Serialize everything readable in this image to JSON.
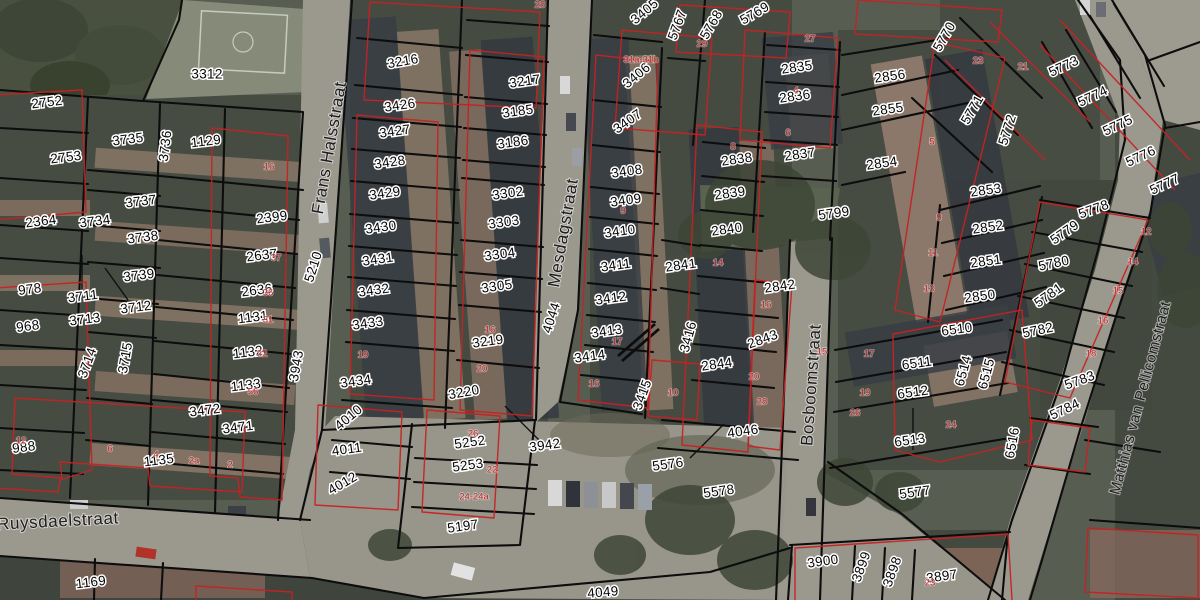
{
  "map": {
    "type": "cadastral-aerial-map",
    "colors": {
      "parcel_line": "#0d0d0d",
      "building_outline": "#c62222",
      "red_label": "#c22121",
      "halo": "#ffffff"
    },
    "streets": [
      {
        "label": "Frans Halsstraat",
        "x": 330,
        "y": 148,
        "r": -80,
        "s": 17
      },
      {
        "label": "Mesdagstraat",
        "x": 564,
        "y": 233,
        "r": -80,
        "s": 17
      },
      {
        "label": "Bosboomstraat",
        "x": 812,
        "y": 385,
        "r": -86,
        "s": 17
      },
      {
        "label": "Matthias van Pellicomstraat",
        "x": 1141,
        "y": 398,
        "r": -75,
        "s": 15
      },
      {
        "label": "Ruysdaelstraat",
        "x": 58,
        "y": 522,
        "r": -3,
        "s": 17
      }
    ],
    "parcels": [
      {
        "id": "3312",
        "x": 207,
        "y": 75,
        "r": 0
      },
      {
        "id": "2752",
        "x": 47,
        "y": 103,
        "r": -7
      },
      {
        "id": "2753",
        "x": 66,
        "y": 158,
        "r": -7
      },
      {
        "id": "3735",
        "x": 128,
        "y": 140,
        "r": -7
      },
      {
        "id": "3736",
        "x": 166,
        "y": 146,
        "r": -83
      },
      {
        "id": "1129",
        "x": 206,
        "y": 142,
        "r": -7
      },
      {
        "id": "2364",
        "x": 41,
        "y": 222,
        "r": -7
      },
      {
        "id": "3734",
        "x": 95,
        "y": 222,
        "r": -7
      },
      {
        "id": "3737",
        "x": 141,
        "y": 202,
        "r": -7
      },
      {
        "id": "3738",
        "x": 143,
        "y": 238,
        "r": -7
      },
      {
        "id": "3739",
        "x": 139,
        "y": 276,
        "r": -7
      },
      {
        "id": "978",
        "x": 30,
        "y": 290,
        "r": -7
      },
      {
        "id": "3711",
        "x": 83,
        "y": 297,
        "r": -7
      },
      {
        "id": "3712",
        "x": 136,
        "y": 308,
        "r": -7
      },
      {
        "id": "3713",
        "x": 85,
        "y": 320,
        "r": -7
      },
      {
        "id": "968",
        "x": 28,
        "y": 327,
        "r": -7
      },
      {
        "id": "2399",
        "x": 272,
        "y": 218,
        "r": -7
      },
      {
        "id": "2637",
        "x": 262,
        "y": 256,
        "r": -7
      },
      {
        "id": "2636",
        "x": 257,
        "y": 291,
        "r": -7
      },
      {
        "id": "1131",
        "x": 253,
        "y": 318,
        "r": -7
      },
      {
        "id": "1132",
        "x": 248,
        "y": 353,
        "r": -7
      },
      {
        "id": "1133",
        "x": 246,
        "y": 386,
        "r": -7
      },
      {
        "id": "3714",
        "x": 88,
        "y": 363,
        "r": -70
      },
      {
        "id": "3715",
        "x": 126,
        "y": 358,
        "r": -80
      },
      {
        "id": "3472",
        "x": 205,
        "y": 411,
        "r": -7
      },
      {
        "id": "3471",
        "x": 238,
        "y": 428,
        "r": -7
      },
      {
        "id": "988",
        "x": 24,
        "y": 448,
        "r": -7
      },
      {
        "id": "1135",
        "x": 159,
        "y": 461,
        "r": -7
      },
      {
        "id": "1169",
        "x": 91,
        "y": 583,
        "r": -7
      },
      {
        "id": "3943",
        "x": 297,
        "y": 366,
        "r": -80
      },
      {
        "id": "5210",
        "x": 314,
        "y": 267,
        "r": -72
      },
      {
        "id": "3216",
        "x": 403,
        "y": 62,
        "r": -10
      },
      {
        "id": "3426",
        "x": 400,
        "y": 106,
        "r": -8
      },
      {
        "id": "3427",
        "x": 395,
        "y": 132,
        "r": -8
      },
      {
        "id": "3428",
        "x": 390,
        "y": 163,
        "r": -8
      },
      {
        "id": "3429",
        "x": 385,
        "y": 194,
        "r": -8
      },
      {
        "id": "3430",
        "x": 381,
        "y": 228,
        "r": -8
      },
      {
        "id": "3431",
        "x": 378,
        "y": 260,
        "r": -8
      },
      {
        "id": "3432",
        "x": 374,
        "y": 291,
        "r": -8
      },
      {
        "id": "3433",
        "x": 368,
        "y": 324,
        "r": -8
      },
      {
        "id": "3434",
        "x": 356,
        "y": 382,
        "r": -8
      },
      {
        "id": "4010",
        "x": 349,
        "y": 418,
        "r": -40
      },
      {
        "id": "4011",
        "x": 347,
        "y": 450,
        "r": -8
      },
      {
        "id": "4012",
        "x": 343,
        "y": 484,
        "r": -30
      },
      {
        "id": "3217",
        "x": 525,
        "y": 82,
        "r": -8
      },
      {
        "id": "3185",
        "x": 518,
        "y": 112,
        "r": -8
      },
      {
        "id": "3186",
        "x": 513,
        "y": 143,
        "r": -8
      },
      {
        "id": "3302",
        "x": 508,
        "y": 194,
        "r": -8
      },
      {
        "id": "3303",
        "x": 504,
        "y": 223,
        "r": -8
      },
      {
        "id": "3304",
        "x": 500,
        "y": 255,
        "r": -8
      },
      {
        "id": "3305",
        "x": 497,
        "y": 287,
        "r": -8
      },
      {
        "id": "3219",
        "x": 488,
        "y": 342,
        "r": -8
      },
      {
        "id": "3220",
        "x": 464,
        "y": 393,
        "r": -10
      },
      {
        "id": "5252",
        "x": 470,
        "y": 443,
        "r": -8
      },
      {
        "id": "5253",
        "x": 468,
        "y": 466,
        "r": -8
      },
      {
        "id": "5197",
        "x": 463,
        "y": 527,
        "r": -8
      },
      {
        "id": "3942",
        "x": 545,
        "y": 446,
        "r": -8
      },
      {
        "id": "4044",
        "x": 552,
        "y": 318,
        "r": -72
      },
      {
        "id": "3405",
        "x": 645,
        "y": 12,
        "r": -40
      },
      {
        "id": "3406",
        "x": 637,
        "y": 76,
        "r": -40
      },
      {
        "id": "3407",
        "x": 628,
        "y": 122,
        "r": -35
      },
      {
        "id": "3408",
        "x": 627,
        "y": 172,
        "r": -8
      },
      {
        "id": "3409",
        "x": 626,
        "y": 201,
        "r": -8
      },
      {
        "id": "3410",
        "x": 620,
        "y": 232,
        "r": -8
      },
      {
        "id": "3411",
        "x": 616,
        "y": 266,
        "r": -8
      },
      {
        "id": "3412",
        "x": 611,
        "y": 299,
        "r": -8
      },
      {
        "id": "3413",
        "x": 607,
        "y": 332,
        "r": -8
      },
      {
        "id": "3414",
        "x": 590,
        "y": 357,
        "r": -8
      },
      {
        "id": "3415",
        "x": 643,
        "y": 395,
        "r": -70
      },
      {
        "id": "3416",
        "x": 689,
        "y": 337,
        "r": -75
      },
      {
        "id": "2841",
        "x": 681,
        "y": 266,
        "r": -8
      },
      {
        "id": "5767",
        "x": 678,
        "y": 25,
        "r": -70
      },
      {
        "id": "5768",
        "x": 712,
        "y": 25,
        "r": -60
      },
      {
        "id": "5769",
        "x": 755,
        "y": 14,
        "r": -30
      },
      {
        "id": "2835",
        "x": 797,
        "y": 68,
        "r": -8
      },
      {
        "id": "2836",
        "x": 795,
        "y": 97,
        "r": -8
      },
      {
        "id": "2837",
        "x": 800,
        "y": 155,
        "r": -8
      },
      {
        "id": "2838",
        "x": 737,
        "y": 160,
        "r": -8
      },
      {
        "id": "2839",
        "x": 730,
        "y": 194,
        "r": -8
      },
      {
        "id": "2840",
        "x": 727,
        "y": 230,
        "r": -8
      },
      {
        "id": "2842",
        "x": 780,
        "y": 287,
        "r": -8
      },
      {
        "id": "2843",
        "x": 763,
        "y": 340,
        "r": -20
      },
      {
        "id": "2844",
        "x": 717,
        "y": 365,
        "r": -8
      },
      {
        "id": "4046",
        "x": 743,
        "y": 432,
        "r": -8
      },
      {
        "id": "5576",
        "x": 668,
        "y": 465,
        "r": -8
      },
      {
        "id": "5578",
        "x": 719,
        "y": 492,
        "r": -8
      },
      {
        "id": "5799",
        "x": 834,
        "y": 214,
        "r": -8
      },
      {
        "id": "2854",
        "x": 882,
        "y": 164,
        "r": -8
      },
      {
        "id": "2856",
        "x": 890,
        "y": 77,
        "r": -8
      },
      {
        "id": "2855",
        "x": 888,
        "y": 110,
        "r": -8
      },
      {
        "id": "2853",
        "x": 986,
        "y": 191,
        "r": -8
      },
      {
        "id": "2852",
        "x": 988,
        "y": 228,
        "r": -8
      },
      {
        "id": "2851",
        "x": 986,
        "y": 262,
        "r": -8
      },
      {
        "id": "2850",
        "x": 980,
        "y": 297,
        "r": -8
      },
      {
        "id": "6510",
        "x": 957,
        "y": 330,
        "r": -8
      },
      {
        "id": "6511",
        "x": 917,
        "y": 364,
        "r": -8
      },
      {
        "id": "6512",
        "x": 913,
        "y": 393,
        "r": -8
      },
      {
        "id": "6513",
        "x": 910,
        "y": 441,
        "r": -8
      },
      {
        "id": "6514",
        "x": 964,
        "y": 371,
        "r": -75
      },
      {
        "id": "6515",
        "x": 987,
        "y": 374,
        "r": -75
      },
      {
        "id": "6516",
        "x": 1013,
        "y": 443,
        "r": -80
      },
      {
        "id": "5577",
        "x": 915,
        "y": 493,
        "r": -8
      },
      {
        "id": "5784",
        "x": 1065,
        "y": 410,
        "r": -25
      },
      {
        "id": "5770",
        "x": 945,
        "y": 37,
        "r": -60
      },
      {
        "id": "5771",
        "x": 973,
        "y": 110,
        "r": -60
      },
      {
        "id": "5772",
        "x": 1008,
        "y": 130,
        "r": -72
      },
      {
        "id": "5773",
        "x": 1064,
        "y": 67,
        "r": -25
      },
      {
        "id": "5774",
        "x": 1093,
        "y": 97,
        "r": -25
      },
      {
        "id": "5775",
        "x": 1118,
        "y": 126,
        "r": -25
      },
      {
        "id": "5776",
        "x": 1141,
        "y": 157,
        "r": -25
      },
      {
        "id": "5777",
        "x": 1165,
        "y": 185,
        "r": -25
      },
      {
        "id": "5778",
        "x": 1094,
        "y": 210,
        "r": -20
      },
      {
        "id": "5779",
        "x": 1065,
        "y": 233,
        "r": -35
      },
      {
        "id": "5780",
        "x": 1054,
        "y": 264,
        "r": -12
      },
      {
        "id": "5781",
        "x": 1049,
        "y": 296,
        "r": -35
      },
      {
        "id": "5782",
        "x": 1038,
        "y": 331,
        "r": -12
      },
      {
        "id": "5783",
        "x": 1080,
        "y": 381,
        "r": -20
      },
      {
        "id": "3900",
        "x": 823,
        "y": 562,
        "r": -8
      },
      {
        "id": "3899",
        "x": 862,
        "y": 567,
        "r": -70
      },
      {
        "id": "3898",
        "x": 893,
        "y": 572,
        "r": -70
      },
      {
        "id": "3897",
        "x": 942,
        "y": 577,
        "r": -8
      },
      {
        "id": "4049",
        "x": 603,
        "y": 593,
        "r": -5
      }
    ],
    "house_numbers": [
      {
        "n": "16",
        "x": 269,
        "y": 167
      },
      {
        "n": "37",
        "x": 276,
        "y": 258
      },
      {
        "n": "36",
        "x": 268,
        "y": 293
      },
      {
        "n": "31",
        "x": 268,
        "y": 320
      },
      {
        "n": "32",
        "x": 262,
        "y": 354
      },
      {
        "n": "56",
        "x": 253,
        "y": 392
      },
      {
        "n": "12",
        "x": 21,
        "y": 441
      },
      {
        "n": "6",
        "x": 110,
        "y": 449
      },
      {
        "n": "4",
        "x": 156,
        "y": 455
      },
      {
        "n": "2a",
        "x": 194,
        "y": 461
      },
      {
        "n": "2",
        "x": 230,
        "y": 465
      },
      {
        "n": "28",
        "x": 540,
        "y": 5
      },
      {
        "n": "19",
        "x": 363,
        "y": 355
      },
      {
        "n": "16",
        "x": 490,
        "y": 330
      },
      {
        "n": "20",
        "x": 482,
        "y": 369
      },
      {
        "n": "26",
        "x": 473,
        "y": 434
      },
      {
        "n": "22",
        "x": 492,
        "y": 470
      },
      {
        "n": "24-24a",
        "x": 474,
        "y": 497
      },
      {
        "n": "29",
        "x": 702,
        "y": 44
      },
      {
        "n": "31a-31b",
        "x": 641,
        "y": 60
      },
      {
        "n": "27",
        "x": 810,
        "y": 39
      },
      {
        "n": "4",
        "x": 796,
        "y": 91
      },
      {
        "n": "6",
        "x": 788,
        "y": 133
      },
      {
        "n": "8",
        "x": 733,
        "y": 147
      },
      {
        "n": "9",
        "x": 623,
        "y": 211
      },
      {
        "n": "14",
        "x": 718,
        "y": 263
      },
      {
        "n": "16",
        "x": 766,
        "y": 305
      },
      {
        "n": "17",
        "x": 617,
        "y": 342
      },
      {
        "n": "16",
        "x": 594,
        "y": 384
      },
      {
        "n": "10",
        "x": 673,
        "y": 393
      },
      {
        "n": "20",
        "x": 754,
        "y": 377
      },
      {
        "n": "15",
        "x": 822,
        "y": 352
      },
      {
        "n": "17",
        "x": 869,
        "y": 354
      },
      {
        "n": "19",
        "x": 865,
        "y": 393
      },
      {
        "n": "26",
        "x": 855,
        "y": 413
      },
      {
        "n": "28",
        "x": 762,
        "y": 402
      },
      {
        "n": "23",
        "x": 978,
        "y": 61
      },
      {
        "n": "21",
        "x": 1023,
        "y": 67
      },
      {
        "n": "5",
        "x": 932,
        "y": 142
      },
      {
        "n": "9",
        "x": 939,
        "y": 218
      },
      {
        "n": "11",
        "x": 933,
        "y": 253
      },
      {
        "n": "13",
        "x": 929,
        "y": 289
      },
      {
        "n": "12",
        "x": 1146,
        "y": 232
      },
      {
        "n": "14",
        "x": 1133,
        "y": 262
      },
      {
        "n": "15",
        "x": 1118,
        "y": 291
      },
      {
        "n": "16",
        "x": 1103,
        "y": 321
      },
      {
        "n": "18",
        "x": 1091,
        "y": 354
      },
      {
        "n": "24",
        "x": 951,
        "y": 425
      },
      {
        "n": "23",
        "x": 930,
        "y": 583
      }
    ]
  }
}
